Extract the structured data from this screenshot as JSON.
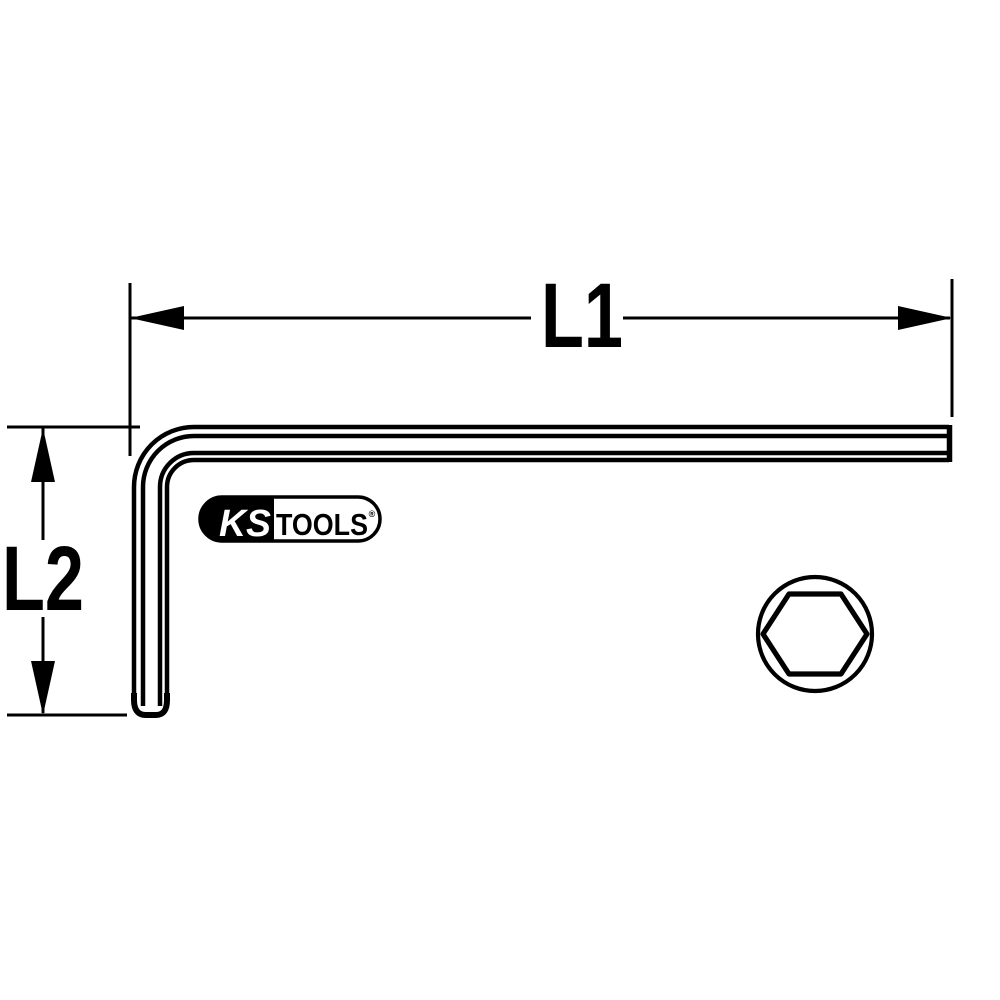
{
  "page": {
    "background_color": "#ffffff",
    "line_color": "#000000",
    "kind": "technical-line-drawing-hex-key"
  },
  "dimensions": {
    "l1": {
      "label": "L1"
    },
    "l2": {
      "label": "L2"
    }
  },
  "logo": {
    "brand_left": "KS",
    "brand_right": "TOOLS",
    "registered_mark": "®",
    "left_fill": "#000000",
    "right_fill": "#ffffff",
    "text_left_color": "#ffffff",
    "text_right_color": "#000000"
  },
  "cross_section": {
    "icon": "hexagon-cross-section-icon",
    "shape": "hexagon inscribed in circle"
  }
}
